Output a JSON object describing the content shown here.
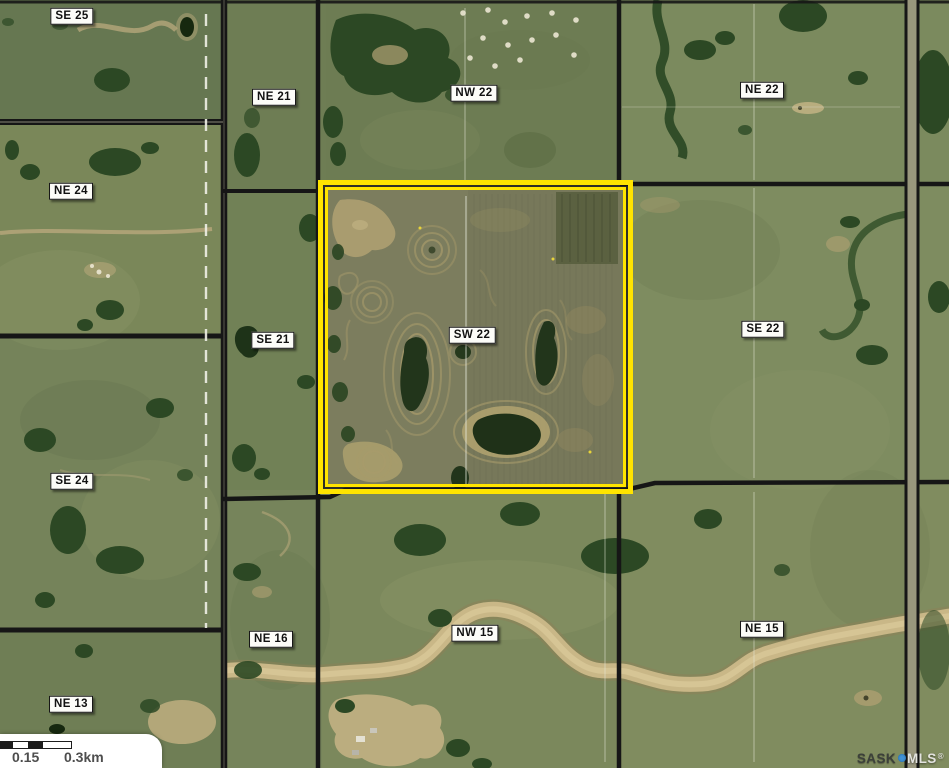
{
  "map": {
    "type": "satellite-parcel-map",
    "parcels": [
      {
        "label": "SE 25",
        "x": 72,
        "y": 16,
        "highlighted": false
      },
      {
        "label": "NE 21",
        "x": 274,
        "y": 97,
        "highlighted": false
      },
      {
        "label": "NW 22",
        "x": 474,
        "y": 93,
        "highlighted": false
      },
      {
        "label": "NE 22",
        "x": 762,
        "y": 90,
        "highlighted": false
      },
      {
        "label": "NE 24",
        "x": 71,
        "y": 191,
        "highlighted": false
      },
      {
        "label": "SE 21",
        "x": 273,
        "y": 340,
        "highlighted": false
      },
      {
        "label": "SW 22",
        "x": 472,
        "y": 335,
        "highlighted": true
      },
      {
        "label": "SE 22",
        "x": 763,
        "y": 329,
        "highlighted": false
      },
      {
        "label": "SE 24",
        "x": 72,
        "y": 481,
        "highlighted": false
      },
      {
        "label": "NE 16",
        "x": 271,
        "y": 639,
        "highlighted": false
      },
      {
        "label": "NW 15",
        "x": 475,
        "y": 633,
        "highlighted": false
      },
      {
        "label": "NE 15",
        "x": 762,
        "y": 629,
        "highlighted": false
      },
      {
        "label": "NE 13",
        "x": 71,
        "y": 704,
        "highlighted": false
      }
    ],
    "highlight": {
      "parcel": "SW 22",
      "color": "#ffe400",
      "x": 318,
      "y": 180,
      "width": 315,
      "height": 314
    },
    "scale_bar": {
      "label_mid": "0.15",
      "label_end": "0.3km"
    },
    "watermark": {
      "prefix": "SASK",
      "suffix": "MLS",
      "registered": "®",
      "dot_color": "#4193d6"
    }
  },
  "colors": {
    "highlight_yellow": "#ffe400",
    "road_black": "#161616",
    "field_green": "#74815a",
    "creek_tan": "#c9b787",
    "label_background": "#fcfcf8"
  }
}
